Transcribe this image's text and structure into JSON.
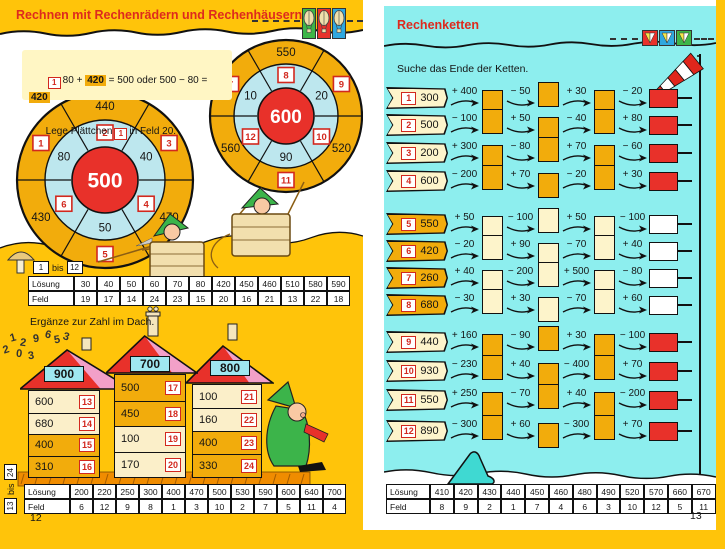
{
  "colors": {
    "page_yellow": "#FFC40A",
    "page_cyan": "#8DEEEE",
    "accent_red": "#E8312A",
    "gold": "#F2AC0C",
    "cream": "#FBEFC9",
    "pale_yellow": "#FDF4CB",
    "light_blue": "#BDE7EE",
    "roof_pink": "#F2A0C8",
    "ground_orange": "#F08C00",
    "title_red": "#DE2A1E"
  },
  "left_page": {
    "title": "Rechnen mit Rechenrädern und Rechenhäusern",
    "page_number": "12",
    "example": {
      "chip": "1",
      "p1": "80 + ",
      "hl1": "420",
      "p2": " = 500 oder 500 − 80 = ",
      "hl2": "420",
      "l2a": "Lege Plättchen",
      "chip2": "1",
      "l2b": "in Feld 20."
    },
    "wheels": [
      {
        "name": "rechenrad-500",
        "center": "500",
        "outer": {
          "top": {
            "kind": "num",
            "v": "440"
          },
          "upper_right": {
            "kind": "chip",
            "v": "3"
          },
          "lower_right": {
            "kind": "num",
            "v": "470"
          },
          "bottom": {
            "kind": "chip",
            "v": "5"
          },
          "lower_left": {
            "kind": "num",
            "v": "430"
          },
          "upper_left": {
            "kind": "chip",
            "v": "1"
          }
        },
        "inner": {
          "top": {
            "kind": "chip",
            "v": "2"
          },
          "upper_right": {
            "kind": "num",
            "v": "40"
          },
          "lower_right": {
            "kind": "chip",
            "v": "4"
          },
          "bottom": {
            "kind": "num",
            "v": "50"
          },
          "lower_left": {
            "kind": "chip",
            "v": "6"
          },
          "upper_left": {
            "kind": "num",
            "v": "80"
          }
        }
      },
      {
        "name": "rechenrad-600",
        "center": "600",
        "outer": {
          "top": {
            "kind": "num",
            "v": "550"
          },
          "upper_right": {
            "kind": "chip",
            "v": "9"
          },
          "lower_right": {
            "kind": "num",
            "v": "520"
          },
          "bottom": {
            "kind": "chip",
            "v": "11"
          },
          "lower_left": {
            "kind": "num",
            "v": "560"
          },
          "upper_left": {
            "kind": "chip",
            "v": "7"
          }
        },
        "inner": {
          "top": {
            "kind": "chip",
            "v": "8"
          },
          "upper_right": {
            "kind": "num",
            "v": "20"
          },
          "lower_right": {
            "kind": "chip",
            "v": "10"
          },
          "bottom": {
            "kind": "num",
            "v": "90"
          },
          "lower_left": {
            "kind": "chip",
            "v": "12"
          },
          "upper_left": {
            "kind": "num",
            "v": "10"
          }
        }
      }
    ],
    "range1": {
      "from": "1",
      "word": "bis",
      "to": "12"
    },
    "table1": {
      "row1_label": "Lösung",
      "row1": [
        "30",
        "40",
        "50",
        "60",
        "70",
        "80",
        "420",
        "450",
        "460",
        "510",
        "580",
        "590"
      ],
      "row2_label": "Feld",
      "row2": [
        "19",
        "17",
        "14",
        "24",
        "23",
        "15",
        "20",
        "16",
        "21",
        "13",
        "22",
        "18"
      ]
    },
    "houses_heading": "Ergänze zur Zahl im Dach.",
    "doodle_digits": [
      "1",
      "2",
      "9",
      "6",
      "5",
      "3",
      "2",
      "0",
      "3"
    ],
    "houses": [
      {
        "roof": "900",
        "rows": [
          {
            "value": "600",
            "chip": "13",
            "bg": "cream"
          },
          {
            "value": "680",
            "chip": "14",
            "bg": "cream"
          },
          {
            "value": "400",
            "chip": "15",
            "bg": "gold"
          },
          {
            "value": "310",
            "chip": "16",
            "bg": "gold"
          }
        ]
      },
      {
        "roof": "700",
        "rows": [
          {
            "value": "500",
            "chip": "17",
            "bg": "gold"
          },
          {
            "value": "450",
            "chip": "18",
            "bg": "gold"
          },
          {
            "value": "100",
            "chip": "19",
            "bg": "cream"
          },
          {
            "value": "170",
            "chip": "20",
            "bg": "cream"
          }
        ]
      },
      {
        "roof": "800",
        "rows": [
          {
            "value": "100",
            "chip": "21",
            "bg": "cream"
          },
          {
            "value": "160",
            "chip": "22",
            "bg": "cream"
          },
          {
            "value": "400",
            "chip": "23",
            "bg": "gold"
          },
          {
            "value": "330",
            "chip": "24",
            "bg": "gold"
          }
        ]
      }
    ],
    "range2": {
      "from": "13",
      "word": "bis",
      "to": "24"
    },
    "table2": {
      "row1_label": "Lösung",
      "row1": [
        "200",
        "220",
        "250",
        "300",
        "400",
        "470",
        "500",
        "530",
        "590",
        "600",
        "640",
        "700"
      ],
      "row2_label": "Feld",
      "row2": [
        "6",
        "12",
        "9",
        "8",
        "1",
        "3",
        "10",
        "2",
        "7",
        "5",
        "11",
        "4"
      ]
    }
  },
  "right_page": {
    "title": "Rechenketten",
    "subtitle": "Suche das Ende der Ketten.",
    "page_number": "13",
    "chains": [
      {
        "id": "1",
        "start": "300",
        "ops": [
          "+ 400",
          "− 50",
          "+ 30",
          "− 20"
        ],
        "group": 1
      },
      {
        "id": "2",
        "start": "500",
        "ops": [
          "− 100",
          "+ 50",
          "− 40",
          "+ 80"
        ],
        "group": 1
      },
      {
        "id": "3",
        "start": "200",
        "ops": [
          "+ 300",
          "− 80",
          "+ 70",
          "− 60"
        ],
        "group": 1
      },
      {
        "id": "4",
        "start": "600",
        "ops": [
          "− 200",
          "+ 70",
          "− 20",
          "+ 30"
        ],
        "group": 1
      },
      {
        "id": "5",
        "start": "550",
        "ops": [
          "+ 50",
          "− 100",
          "+ 50",
          "− 100"
        ],
        "group": 2
      },
      {
        "id": "6",
        "start": "420",
        "ops": [
          "− 20",
          "+ 90",
          "− 70",
          "+ 40"
        ],
        "group": 2
      },
      {
        "id": "7",
        "start": "260",
        "ops": [
          "+ 40",
          "− 200",
          "+ 500",
          "− 80"
        ],
        "group": 2
      },
      {
        "id": "8",
        "start": "680",
        "ops": [
          "− 30",
          "+ 30",
          "− 70",
          "+ 60"
        ],
        "group": 2
      },
      {
        "id": "9",
        "start": "440",
        "ops": [
          "+ 160",
          "− 90",
          "+ 30",
          "− 100"
        ],
        "group": 3
      },
      {
        "id": "10",
        "start": "930",
        "ops": [
          "− 230",
          "+ 40",
          "− 400",
          "+ 70"
        ],
        "group": 3
      },
      {
        "id": "11",
        "start": "550",
        "ops": [
          "+ 250",
          "− 70",
          "+ 40",
          "− 200"
        ],
        "group": 3
      },
      {
        "id": "12",
        "start": "890",
        "ops": [
          "− 300",
          "+ 60",
          "− 300",
          "+ 70"
        ],
        "group": 3
      }
    ],
    "table": {
      "row1_label": "Lösung",
      "row1": [
        "410",
        "420",
        "430",
        "440",
        "450",
        "460",
        "480",
        "490",
        "520",
        "570",
        "660",
        "670"
      ],
      "row2_label": "Feld",
      "row2": [
        "8",
        "9",
        "2",
        "1",
        "7",
        "4",
        "6",
        "3",
        "10",
        "12",
        "5",
        "11"
      ]
    }
  }
}
